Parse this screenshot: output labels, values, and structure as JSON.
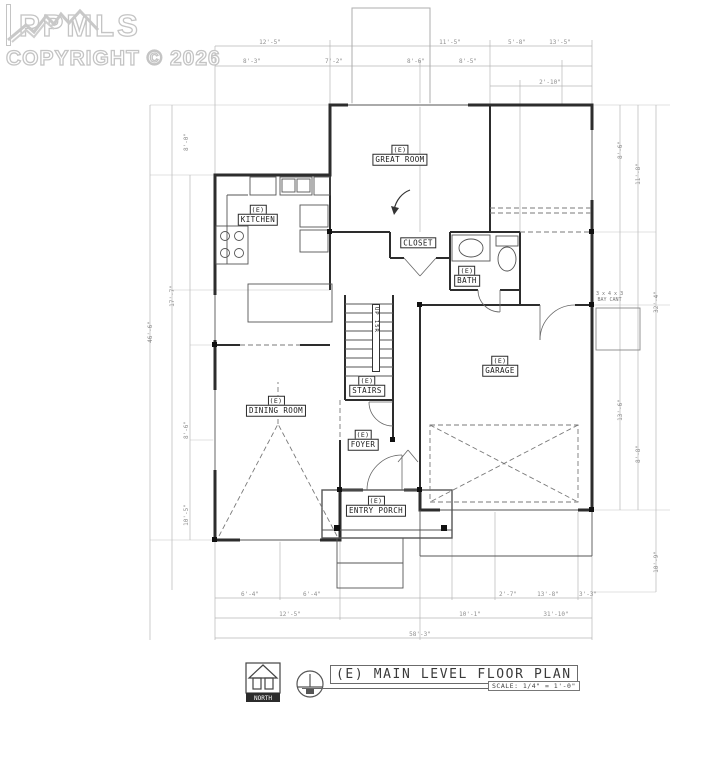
{
  "watermark": {
    "brand": "PPMLS",
    "copyright": "COPYRIGHT © 2026",
    "logo": "mountain-logo"
  },
  "rooms": {
    "great_room": {
      "prefix": "(E)",
      "name": "GREAT ROOM"
    },
    "kitchen": {
      "prefix": "(E)",
      "name": "KITCHEN"
    },
    "closet": {
      "name": "CLOSET"
    },
    "bath": {
      "prefix": "(E)",
      "name": "BATH"
    },
    "garage": {
      "prefix": "(E)",
      "name": "GARAGE"
    },
    "dining": {
      "prefix": "(E)",
      "name": "DINING ROOM"
    },
    "stairs": {
      "prefix": "(E)",
      "name": "STAIRS"
    },
    "foyer": {
      "prefix": "(E)",
      "name": "FOYER"
    },
    "porch": {
      "prefix": "(E)",
      "name": "ENTRY PORCH"
    },
    "stairs_direction": "UP 15R"
  },
  "annotations": {
    "bay_line1": "3 x 4 x 3",
    "bay_line2": "BAY CANT"
  },
  "title_block": {
    "title": "(E) MAIN LEVEL FLOOR PLAN",
    "scale": "SCALE:  1/4\" = 1'-0\"",
    "north": "NORTH"
  },
  "dimensions": {
    "top": [
      "12'-5\"",
      "11'-5\"",
      "5'-8\"",
      "13'-5\"",
      "8'-3\"",
      "7'-2\"",
      "8'-6\"",
      "8'-5\"",
      "2'-10\""
    ],
    "left": [
      "46'-6\"",
      "8'-0\"",
      "17'-7\"",
      "8'-6\"",
      "10'-5\""
    ],
    "right": [
      "8'-6\"",
      "11'-8\"",
      "32'-4\"",
      "13'-6\"",
      "8'-8\"",
      "10'-9\""
    ],
    "bottom": [
      "6'-4\"",
      "6'-4\"",
      "2'-7\"",
      "13'-8\"",
      "3'-3\"",
      "12'-5\"",
      "10'-1\"",
      "31'-10\"",
      "58'-3\""
    ]
  }
}
